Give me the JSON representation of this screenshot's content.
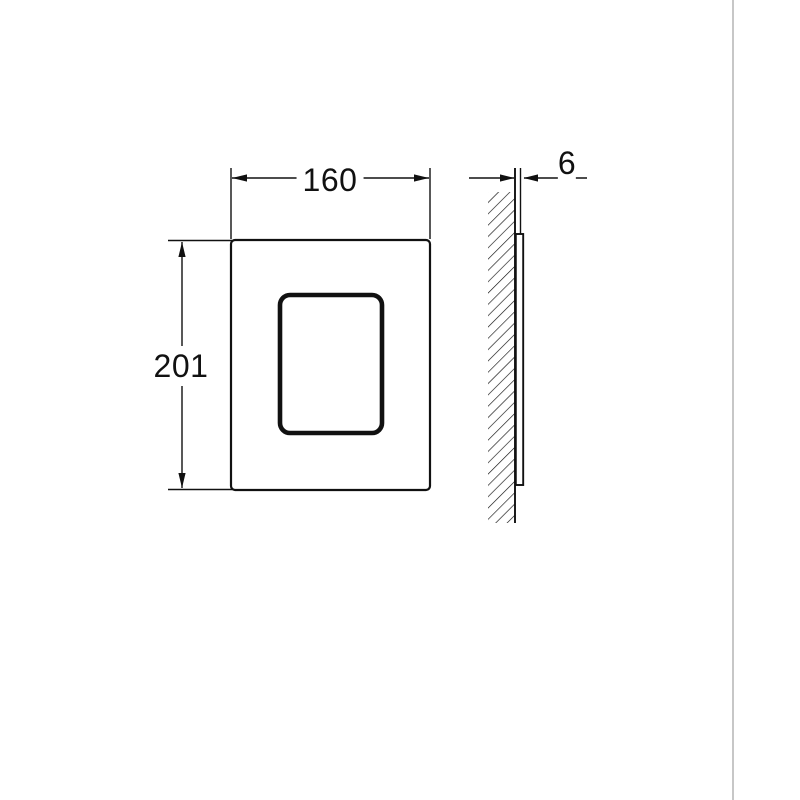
{
  "page": {
    "background": "#ffffff",
    "divider_color": "#c7c7c7"
  },
  "drawing": {
    "type": "technical-dimension-drawing",
    "line_color": "#111111",
    "front_view": {
      "width_label": "160",
      "height_label": "201"
    },
    "side_view": {
      "depth_label": "6"
    }
  }
}
